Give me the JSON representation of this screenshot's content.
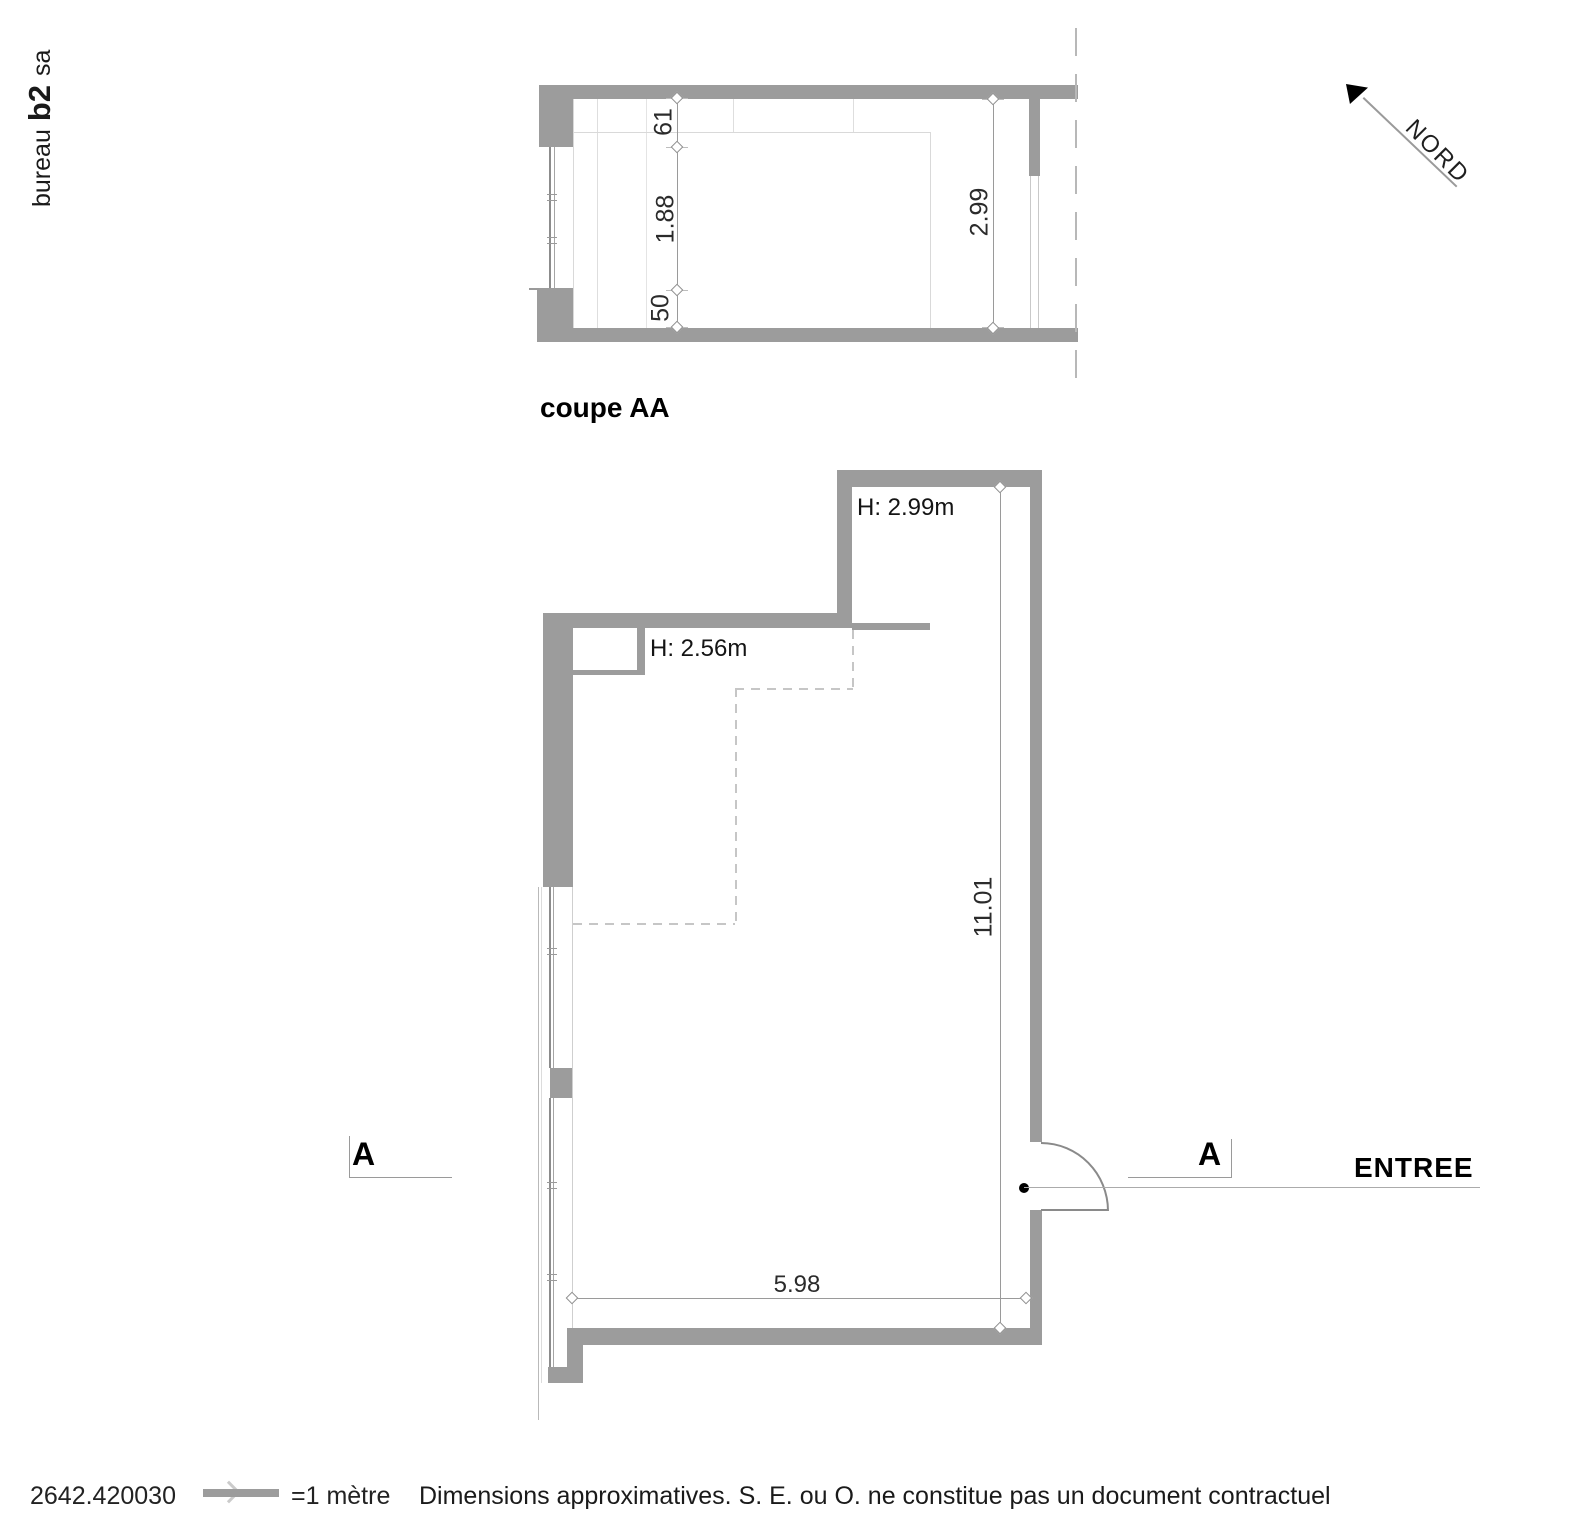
{
  "logo": {
    "part1": "bureau",
    "part2": "b2",
    "part3": "sa"
  },
  "section": {
    "title": "coupe AA",
    "dim_lintel": "61",
    "dim_window": "1.88",
    "dim_sill": "50",
    "dim_height": "2.99"
  },
  "compass": {
    "label": "NORD"
  },
  "plan": {
    "height_main": "H: 2.99m",
    "height_low": "H: 2.56m",
    "dim_length": "11.01",
    "dim_width": "5.98",
    "section_marker": "A",
    "entrance_label": "ENTREE"
  },
  "footer": {
    "drawing_number": "2642.420030",
    "scale_label": "=1 mètre",
    "disclaimer": "Dimensions approximatives. S. E. ou O. ne constitue pas un document contractuel"
  },
  "colors": {
    "wall": "#9c9c9c",
    "line": "#9a9a9a",
    "light_line": "#d9d9d9",
    "text": "#111111"
  }
}
